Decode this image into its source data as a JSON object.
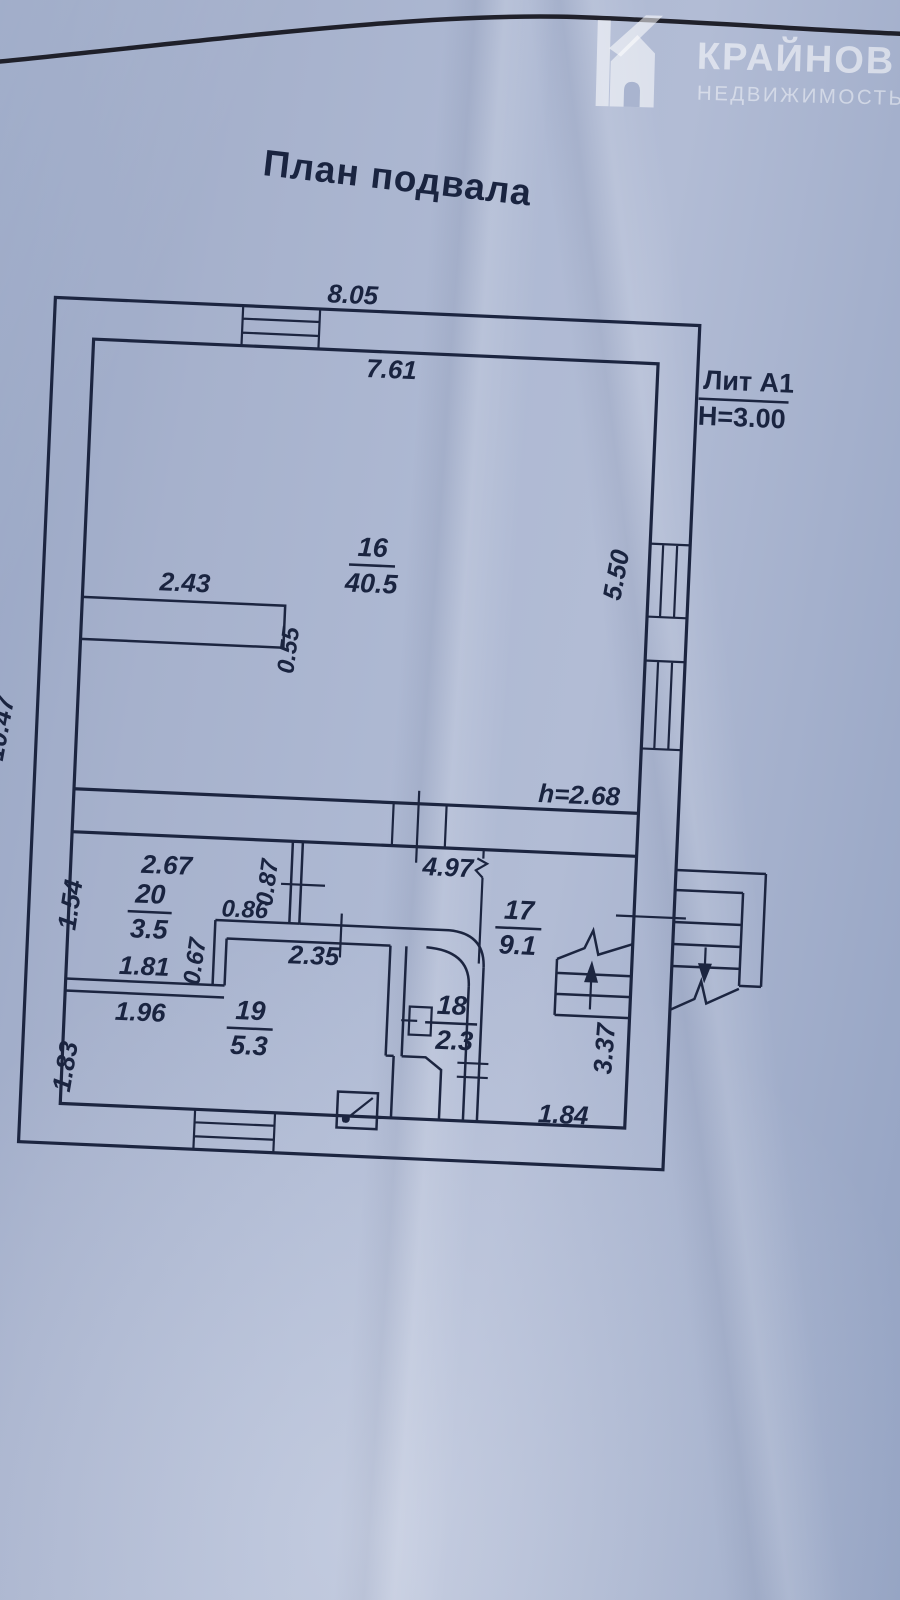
{
  "logo": {
    "brand": "КРАЙНОВ",
    "subtitle": "НЕДВИЖИМОСТЬ",
    "icon": "house-k-icon"
  },
  "title": "План подвала",
  "plan": {
    "lit_label": "Лит А1",
    "building_height": "Н=3.00",
    "ceiling_height": "h=2.68",
    "rooms": {
      "r16": {
        "num": "16",
        "area": "40.5"
      },
      "r17": {
        "num": "17",
        "area": "9.1"
      },
      "r18": {
        "num": "18",
        "area": "2.3"
      },
      "r19": {
        "num": "19",
        "area": "5.3"
      },
      "r20": {
        "num": "20",
        "area": "3.5"
      }
    },
    "dims": {
      "d805": "8.05",
      "d761": "7.61",
      "d243": "2.43",
      "d055": "0.55",
      "d550": "5.50",
      "d1047": "10.47",
      "d497": "4.97",
      "d267": "2.67",
      "d154": "1.54",
      "d087": "0.87",
      "d086": "0.86",
      "d067": "0.67",
      "d235": "2.35",
      "d181": "1.81",
      "d196": "1.96",
      "d183": "1.83",
      "d337": "3.37",
      "d184": "1.84"
    }
  },
  "colors": {
    "ink": "#1c2540",
    "paper": "#a9b4cf",
    "watermark": "#ffffff"
  }
}
